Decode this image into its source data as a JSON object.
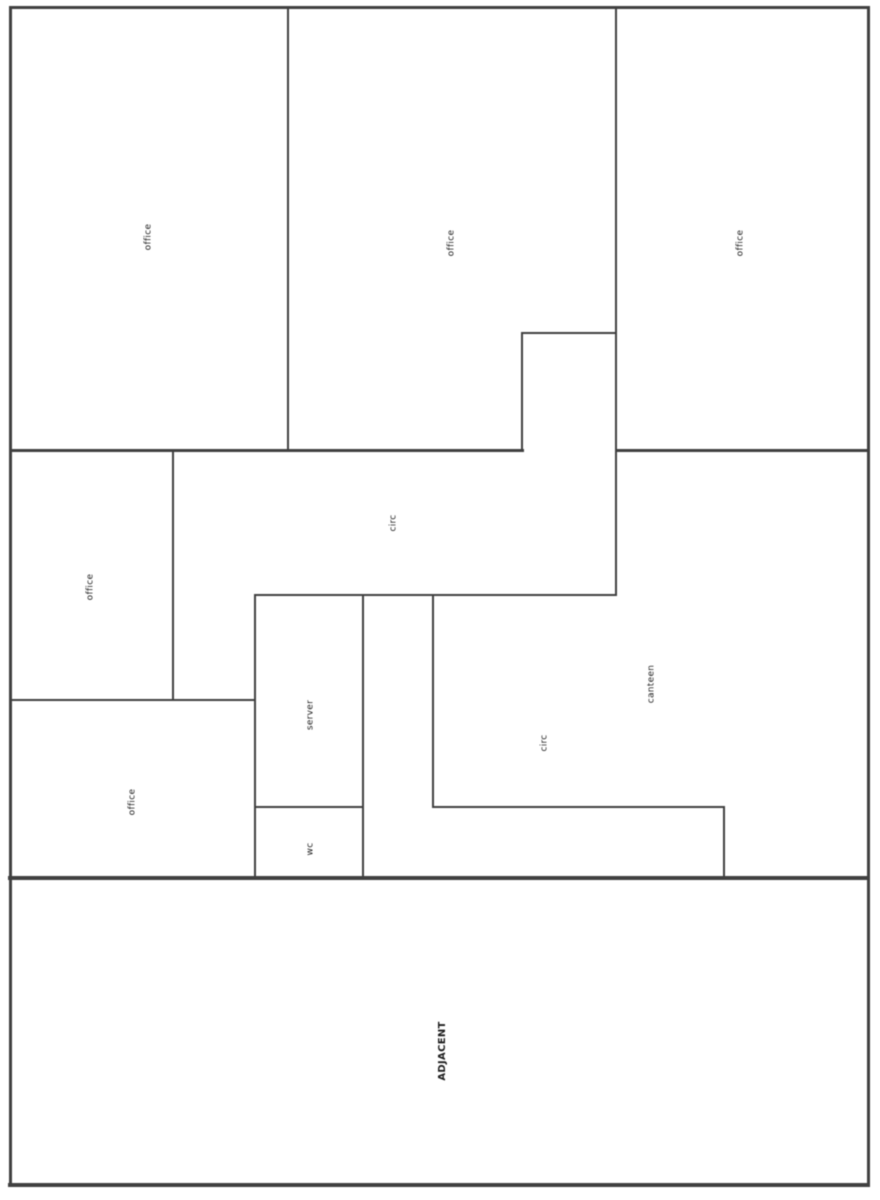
{
  "floorplan": {
    "canvas": {
      "width": 880,
      "height": 1200,
      "background": "#ffffff"
    },
    "wall_color": "#404040",
    "label_color": "#1c1c1c",
    "label_rotation_deg": -90,
    "walls": [
      {
        "name": "outer-top",
        "x1": 10,
        "y1": 7,
        "x2": 868,
        "y2": 7,
        "t": 3
      },
      {
        "name": "outer-left",
        "x1": 10,
        "y1": 7,
        "x2": 10,
        "y2": 1185,
        "t": 3
      },
      {
        "name": "outer-right",
        "x1": 868,
        "y1": 7,
        "x2": 868,
        "y2": 1185,
        "t": 3
      },
      {
        "name": "outer-bottom",
        "x1": 10,
        "y1": 1185,
        "x2": 868,
        "y2": 1185,
        "t": 4
      },
      {
        "name": "office1-office2-wall",
        "x1": 288,
        "y1": 7,
        "x2": 288,
        "y2": 450,
        "t": 2
      },
      {
        "name": "office2-office3-wall",
        "x1": 616,
        "y1": 7,
        "x2": 616,
        "y2": 595,
        "t": 2
      },
      {
        "name": "circ-notch-left",
        "x1": 522,
        "y1": 333,
        "x2": 522,
        "y2": 450,
        "t": 2
      },
      {
        "name": "circ-notch-top",
        "x1": 522,
        "y1": 333,
        "x2": 616,
        "y2": 333,
        "t": 2
      },
      {
        "name": "offices-top-wall-left",
        "x1": 10,
        "y1": 450,
        "x2": 522,
        "y2": 450,
        "t": 3
      },
      {
        "name": "canteen-top-wall",
        "x1": 616,
        "y1": 450,
        "x2": 868,
        "y2": 450,
        "t": 3
      },
      {
        "name": "office4-right-wall",
        "x1": 173,
        "y1": 450,
        "x2": 173,
        "y2": 700,
        "t": 2
      },
      {
        "name": "circ-hall-bottom-wall",
        "x1": 255,
        "y1": 595,
        "x2": 616,
        "y2": 595,
        "t": 2
      },
      {
        "name": "office4-office5-wall",
        "x1": 10,
        "y1": 700,
        "x2": 255,
        "y2": 700,
        "t": 2
      },
      {
        "name": "server-left-wall",
        "x1": 255,
        "y1": 595,
        "x2": 255,
        "y2": 878,
        "t": 2
      },
      {
        "name": "server-right-wall",
        "x1": 363,
        "y1": 595,
        "x2": 363,
        "y2": 878,
        "t": 2
      },
      {
        "name": "server-wc-divider",
        "x1": 255,
        "y1": 807,
        "x2": 363,
        "y2": 807,
        "t": 2
      },
      {
        "name": "circ2-left-wall",
        "x1": 433,
        "y1": 595,
        "x2": 433,
        "y2": 807,
        "t": 2
      },
      {
        "name": "circ2-arm-top-wall",
        "x1": 433,
        "y1": 807,
        "x2": 724,
        "y2": 807,
        "t": 2
      },
      {
        "name": "circ2-arm-right-wall",
        "x1": 724,
        "y1": 807,
        "x2": 724,
        "y2": 878,
        "t": 2
      },
      {
        "name": "adjacent-party-wall",
        "x1": 10,
        "y1": 878,
        "x2": 868,
        "y2": 878,
        "t": 4
      }
    ],
    "rooms": [
      {
        "label": "office",
        "x": 149,
        "y": 237,
        "size": 9,
        "bold": false
      },
      {
        "label": "office",
        "x": 452,
        "y": 243,
        "size": 9,
        "bold": false
      },
      {
        "label": "office",
        "x": 741,
        "y": 243,
        "size": 9,
        "bold": false
      },
      {
        "label": "office",
        "x": 91,
        "y": 587,
        "size": 9,
        "bold": false
      },
      {
        "label": "office",
        "x": 133,
        "y": 802,
        "size": 9,
        "bold": false
      },
      {
        "label": "circ",
        "x": 394,
        "y": 523,
        "size": 9,
        "bold": false
      },
      {
        "label": "server",
        "x": 311,
        "y": 715,
        "size": 9,
        "bold": false
      },
      {
        "label": "wc",
        "x": 311,
        "y": 849,
        "size": 9,
        "bold": false
      },
      {
        "label": "canteen",
        "x": 652,
        "y": 684,
        "size": 9,
        "bold": false
      },
      {
        "label": "circ",
        "x": 545,
        "y": 743,
        "size": 9,
        "bold": false
      },
      {
        "label": "ADJACENT",
        "x": 443,
        "y": 1051,
        "size": 10,
        "bold": true
      }
    ]
  }
}
